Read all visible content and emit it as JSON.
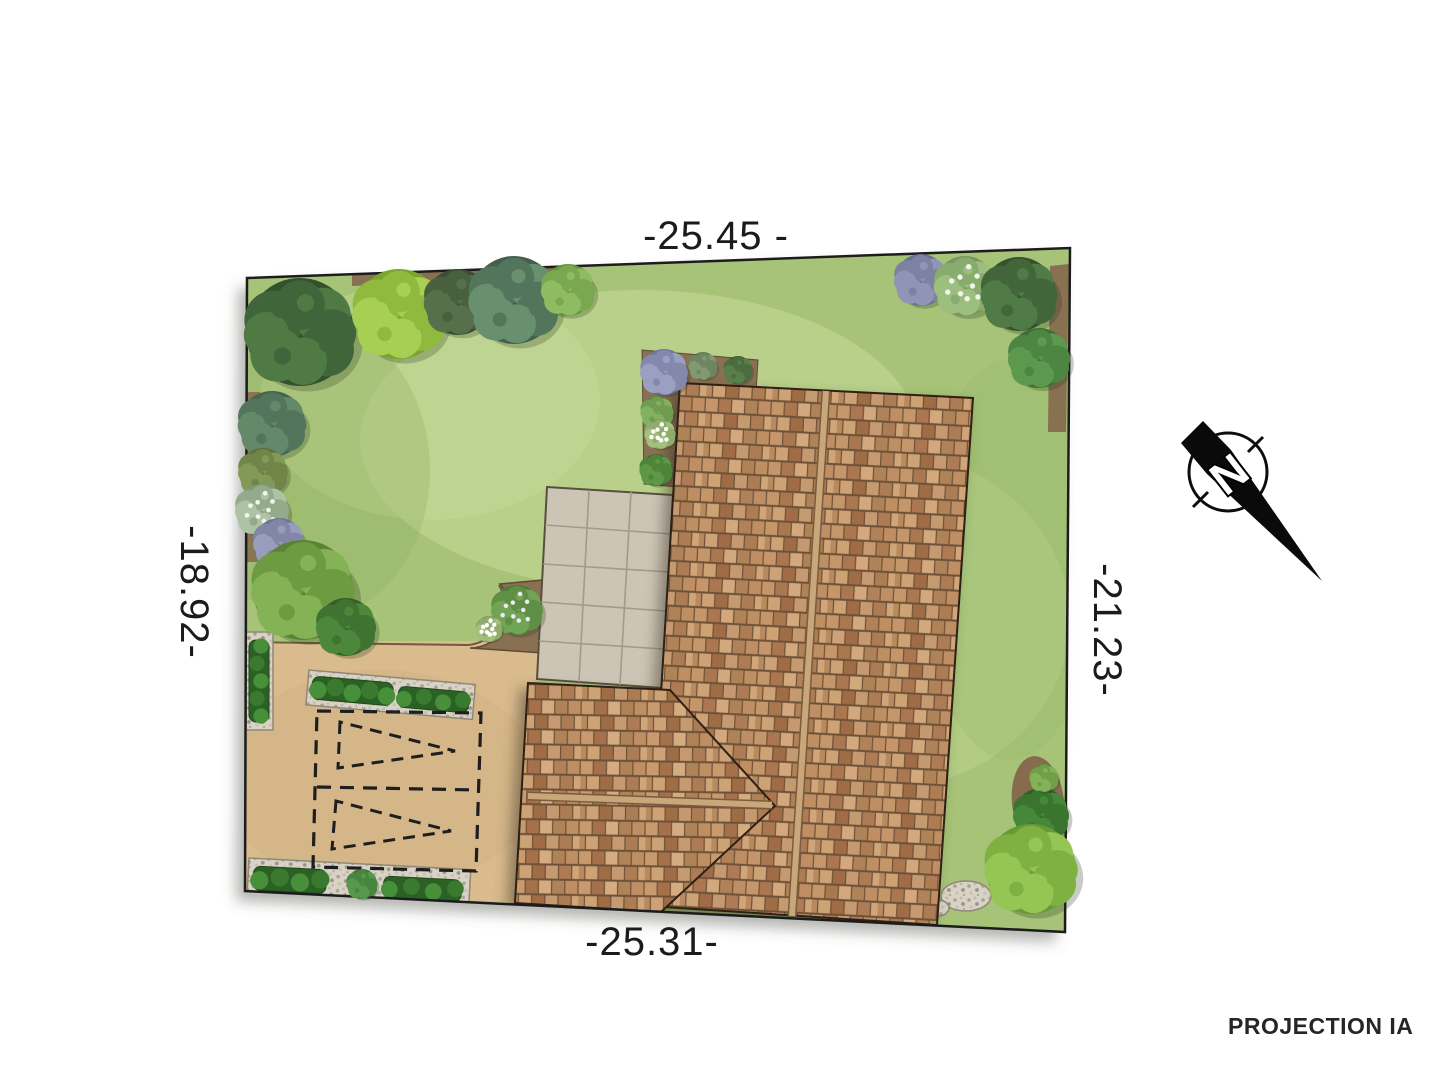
{
  "labels": {
    "dim_top": "-25.45 -",
    "dim_bottom": "-25.31-",
    "dim_left": "-18.92-",
    "dim_right": "-21.23-",
    "north": "N",
    "projection": "PROJECTION IA"
  },
  "colors": {
    "lawn": "#a6c377",
    "driveway": "#d9bb8d",
    "patio": "#ccc5b5",
    "dirt": "#866b4e",
    "hedge": "#2c6125",
    "roof_ridge": "#c9a77a",
    "boundary": "#1c1c1c",
    "text": "#1b1b1b"
  },
  "site": {
    "plants": [
      {
        "name": "tree-dark-top-left",
        "x": 300,
        "y": 332,
        "r": 54,
        "base": "#33512f",
        "mid": "#40653a",
        "light": "#4f7a44"
      },
      {
        "name": "shrub-bluegreen-left",
        "x": 272,
        "y": 424,
        "r": 33,
        "base": "#47634e",
        "mid": "#53755c",
        "light": "#64886a"
      },
      {
        "name": "tree-lime-top",
        "x": 399,
        "y": 314,
        "r": 45,
        "base": "#7aa32f",
        "mid": "#8fba3e",
        "light": "#a6cf53"
      },
      {
        "name": "shrub-dark-top",
        "x": 458,
        "y": 302,
        "r": 33,
        "base": "#3c4c33",
        "mid": "#49603e",
        "light": "#55704a"
      },
      {
        "name": "tree-teal-top",
        "x": 514,
        "y": 300,
        "r": 44,
        "base": "#44604d",
        "mid": "#53755c",
        "light": "#688f6e"
      },
      {
        "name": "bush-green-top",
        "x": 568,
        "y": 290,
        "r": 26,
        "base": "#64913f",
        "mid": "#79a851",
        "light": "#8fbc63"
      },
      {
        "name": "shrub-olive-left",
        "x": 263,
        "y": 472,
        "r": 24,
        "base": "#5d7038",
        "mid": "#708547",
        "light": "#839a56"
      },
      {
        "name": "shrub-silver-left",
        "x": 262,
        "y": 510,
        "r": 26,
        "base": "#7e9677",
        "mid": "#93ab8b",
        "light": "#aec2a4",
        "dots": "#f2f5ec"
      },
      {
        "name": "shrub-lavender-left",
        "x": 279,
        "y": 543,
        "r": 25,
        "base": "#6f7394",
        "mid": "#8287a8",
        "light": "#989dbd"
      },
      {
        "name": "tree-bushy-left",
        "x": 303,
        "y": 590,
        "r": 50,
        "base": "#5a8434",
        "mid": "#6d9b42",
        "light": "#84b254"
      },
      {
        "name": "bush-round-dark",
        "x": 346,
        "y": 627,
        "r": 29,
        "base": "#335f28",
        "mid": "#3f7331",
        "light": "#4c873c"
      },
      {
        "name": "shrub-lavender-house",
        "x": 664,
        "y": 372,
        "r": 23,
        "base": "#70759a",
        "mid": "#8388ac",
        "light": "#9aa0c2"
      },
      {
        "name": "shrub-gray-house",
        "x": 703,
        "y": 366,
        "r": 14,
        "base": "#5c7050",
        "mid": "#6e8560",
        "light": "#819873"
      },
      {
        "name": "bush-dark-house",
        "x": 738,
        "y": 370,
        "r": 14,
        "base": "#3e5a34",
        "mid": "#4b6c3f",
        "light": "#587e4a"
      },
      {
        "name": "bush-flower-bed-house",
        "x": 657,
        "y": 412,
        "r": 16,
        "base": "#5d8742",
        "mid": "#6f9c50",
        "light": "#83b160"
      },
      {
        "name": "flowers-white-house",
        "x": 660,
        "y": 434,
        "r": 15,
        "base": "#7c9a5c",
        "mid": "#8fac6c",
        "light": "#a3bf7d",
        "dots": "#ffffff"
      },
      {
        "name": "bush-round-patio",
        "x": 656,
        "y": 470,
        "r": 16,
        "base": "#41702f",
        "mid": "#4e843a",
        "light": "#5c9846"
      },
      {
        "name": "bush-flower-bed",
        "x": 517,
        "y": 610,
        "r": 25,
        "base": "#4f7a38",
        "mid": "#5f8f45",
        "light": "#72a455",
        "dots": "#efe9f2"
      },
      {
        "name": "flowers-white-bed",
        "x": 489,
        "y": 629,
        "r": 13,
        "base": "#7c9a5c",
        "mid": "#8fac6c",
        "light": "#a3bf7d",
        "dots": "#ffffff"
      },
      {
        "name": "bush-hedge-gap",
        "x": 362,
        "y": 884,
        "r": 15,
        "base": "#3b7030",
        "mid": "#488540",
        "light": "#56994c"
      },
      {
        "name": "boxwood-bottom-right",
        "x": 1041,
        "y": 815,
        "r": 27,
        "base": "#2f6226",
        "mid": "#3a7530",
        "light": "#46883a"
      },
      {
        "name": "tree-lime-bottom-right",
        "x": 1031,
        "y": 869,
        "r": 45,
        "base": "#6a9a33",
        "mid": "#7fb042",
        "light": "#95c553"
      },
      {
        "name": "plant-small-bottom-right",
        "x": 1044,
        "y": 778,
        "r": 14,
        "base": "#5f8a3e",
        "mid": "#719e4b",
        "light": "#84b258"
      },
      {
        "name": "shrub-purple-top-right",
        "x": 921,
        "y": 280,
        "r": 26,
        "base": "#6b7090",
        "mid": "#7d82a2",
        "light": "#9094b6"
      },
      {
        "name": "bush-hydrangea-top-right",
        "x": 965,
        "y": 286,
        "r": 30,
        "base": "#75975e",
        "mid": "#88ab6e",
        "light": "#9cbf7f",
        "dots": "#f0f4ea"
      },
      {
        "name": "tree-dark-top-right",
        "x": 1019,
        "y": 294,
        "r": 37,
        "base": "#35522f",
        "mid": "#42663a",
        "light": "#507a46"
      },
      {
        "name": "bush-green-right",
        "x": 1039,
        "y": 358,
        "r": 30,
        "base": "#3f6f36",
        "mid": "#4d8542",
        "light": "#5c984e"
      }
    ],
    "hedges": [
      {
        "name": "hedge-left",
        "x": 249,
        "y": 640,
        "w": 20,
        "h": 82,
        "rot": 0
      },
      {
        "name": "hedge-mid-a",
        "x": 313,
        "y": 676,
        "w": 81,
        "h": 23,
        "rot": 5
      },
      {
        "name": "hedge-mid-b",
        "x": 399,
        "y": 686,
        "w": 71,
        "h": 21,
        "rot": 5
      },
      {
        "name": "hedge-bottom-a",
        "x": 254,
        "y": 866,
        "w": 73,
        "h": 24,
        "rot": 3
      },
      {
        "name": "hedge-bottom-b",
        "x": 384,
        "y": 876,
        "w": 78,
        "h": 22,
        "rot": 3
      }
    ]
  }
}
